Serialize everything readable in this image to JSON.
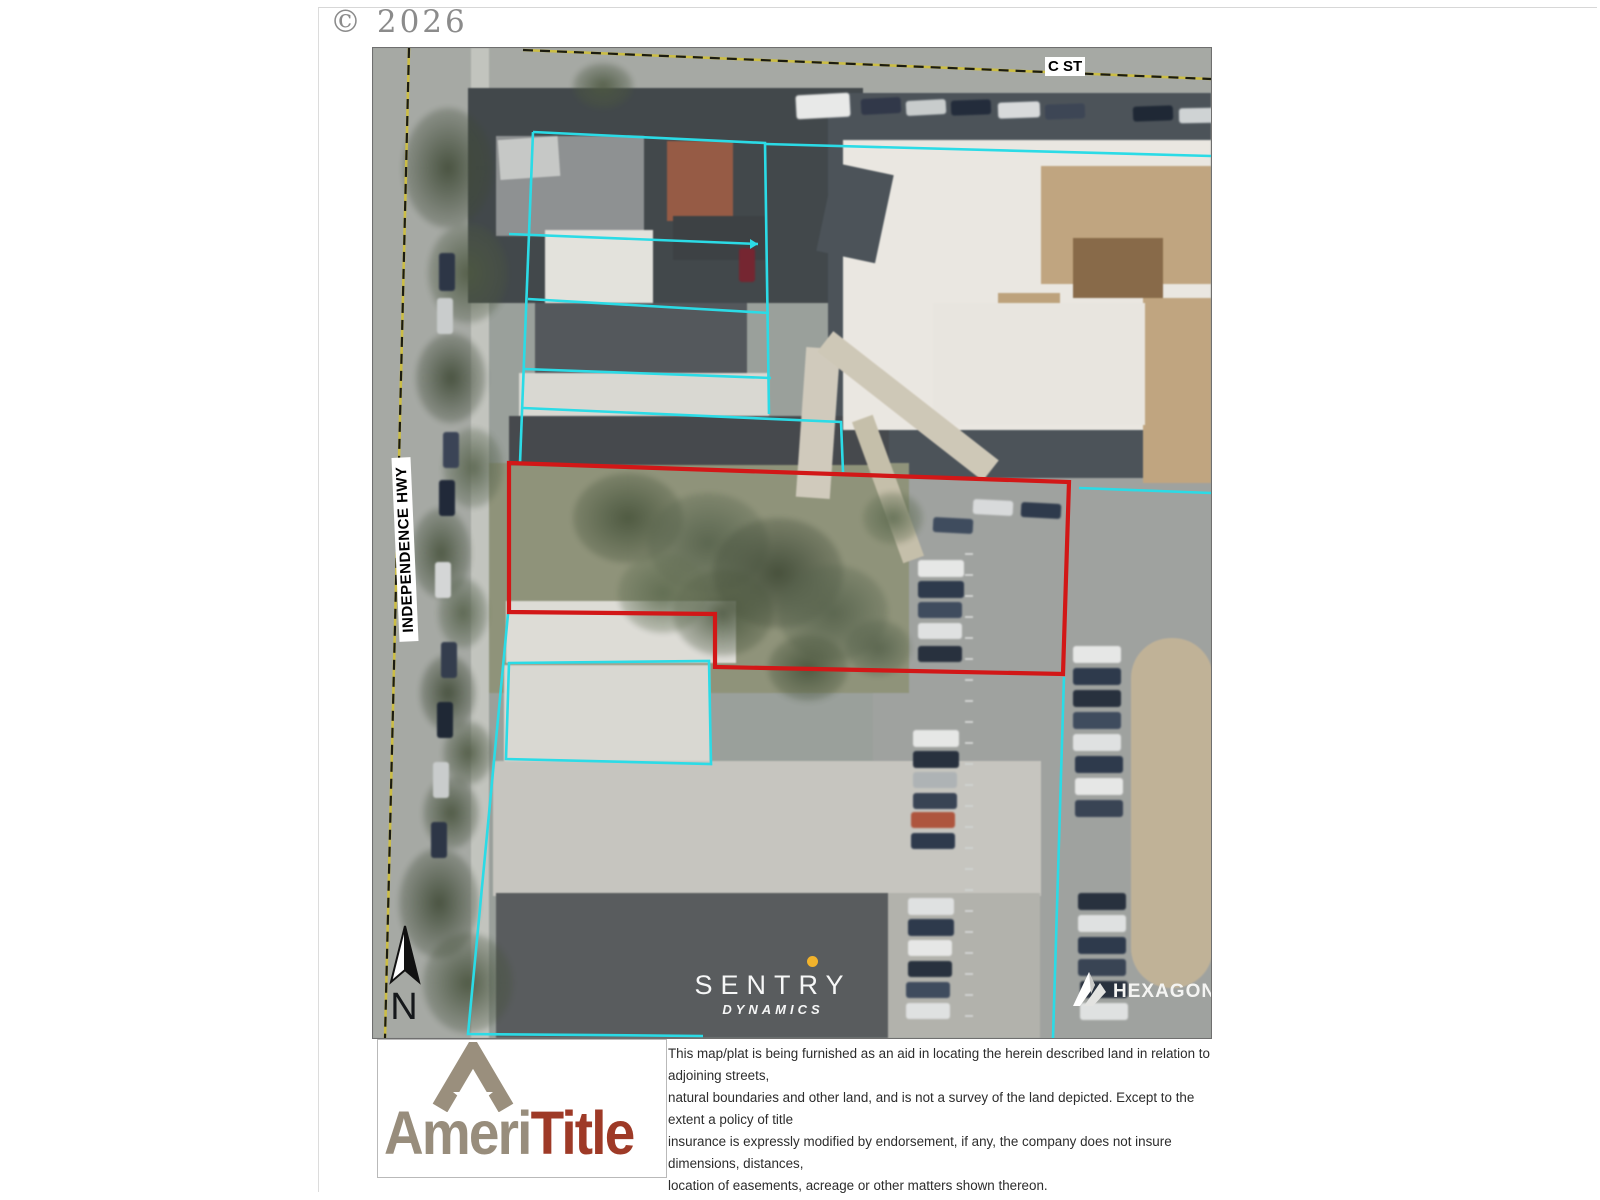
{
  "header": {
    "copyright": "© 2026"
  },
  "map": {
    "street_labels": {
      "c_street": "C ST",
      "independence_hwy": "INDEPENDENCE HWY"
    },
    "north_arrow_label": "N",
    "watermark": {
      "name": "SENTRY",
      "sub": "DYNAMICS"
    },
    "imagery_credit": "HEXAGON",
    "colors": {
      "subject_parcel_outline": "#d21717",
      "parcel_lines": "#2bdbe6",
      "street_centerline": "#cbbd45"
    }
  },
  "footer": {
    "logo": {
      "word_part_1": "Ameri",
      "word_part_2": "Title"
    },
    "disclaimer_lines": [
      "This map/plat is being furnished as an aid in locating the herein described land in relation to adjoining streets,",
      "natural boundaries and other land, and is not a survey of the land depicted. Except to the extent a policy of title",
      "insurance is expressly modified by endorsement, if any, the company does not insure dimensions, distances,",
      "location of easements, acreage or other matters shown thereon."
    ]
  }
}
